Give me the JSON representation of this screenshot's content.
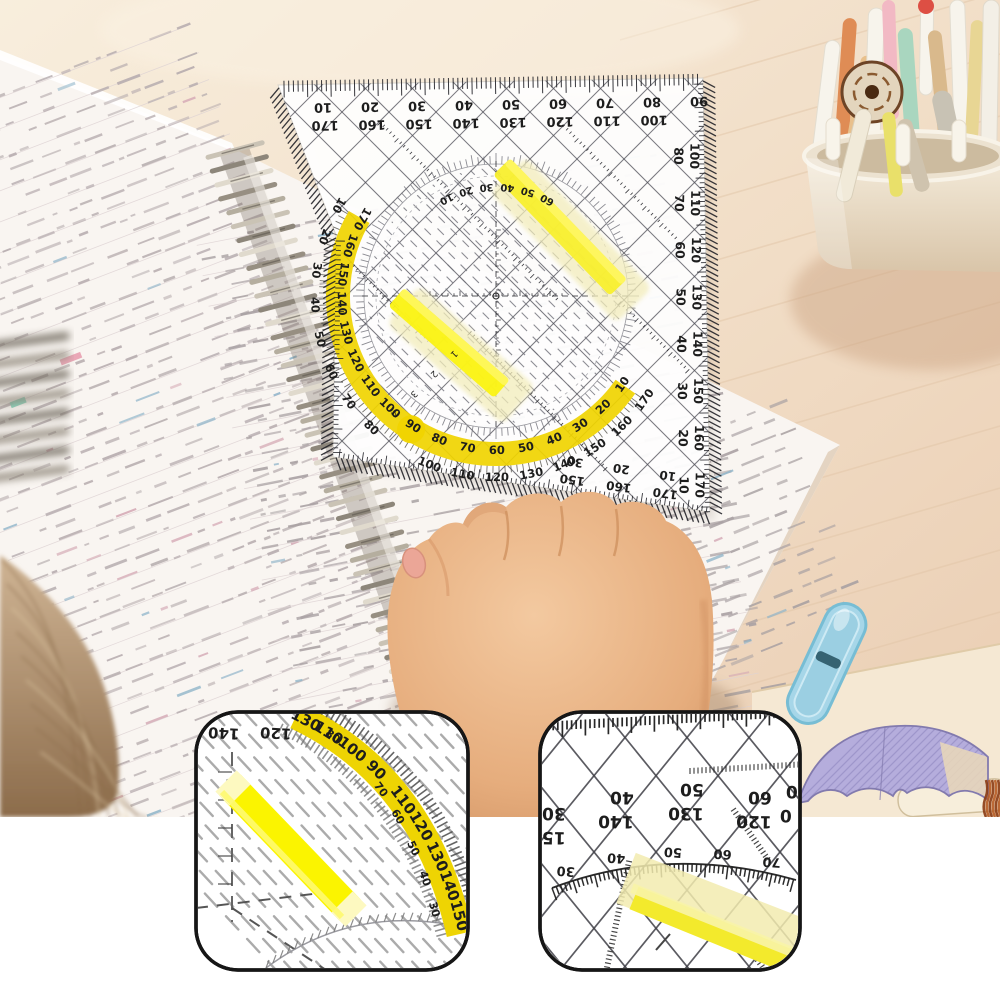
{
  "ruler": {
    "top_row_outer": [
      "10",
      "20",
      "30",
      "40",
      "50",
      "60",
      "70",
      "80",
      "90"
    ],
    "top_row_inner": [
      "170",
      "160",
      "150",
      "140",
      "130",
      "120",
      "110",
      "100"
    ],
    "right_pairs": [
      [
        "80",
        "100"
      ],
      [
        "70",
        "110"
      ],
      [
        "60",
        "120"
      ],
      [
        "50",
        "130"
      ],
      [
        "40",
        "140"
      ],
      [
        "30",
        "150"
      ],
      [
        "20",
        "160"
      ],
      [
        "10",
        "170"
      ]
    ],
    "bottom_pairs": [
      [
        "30",
        "150"
      ],
      [
        "20",
        "160"
      ],
      [
        "10",
        "170"
      ]
    ],
    "arc_outer": [
      "10",
      "20",
      "30",
      "40",
      "50",
      "60",
      "70",
      "80",
      "90",
      "100",
      "110",
      "120",
      "130",
      "140",
      "150",
      "160",
      "170"
    ],
    "arc_inner": [
      "170",
      "160",
      "150",
      "140",
      "130",
      "120",
      "110",
      "100",
      "90",
      "80",
      "70",
      "60",
      "50",
      "40",
      "30",
      "20",
      "10"
    ],
    "inner_top": [
      "10",
      "20",
      "30",
      "40",
      "50",
      "60"
    ],
    "diag_marks": [
      "1",
      "2",
      "3",
      "4"
    ]
  },
  "insets": {
    "left": {
      "corner_numbers": [
        "140",
        "120"
      ],
      "band_pairs": [
        [
          "130",
          ""
        ],
        [
          "110",
          ""
        ],
        [
          "100",
          "80"
        ],
        [
          "90",
          ""
        ],
        [
          "110",
          "70"
        ],
        [
          "120",
          "60"
        ],
        [
          "130",
          "50"
        ],
        [
          "140",
          "40"
        ],
        [
          "150",
          "30"
        ]
      ]
    },
    "right": {
      "pairs": [
        [
          "30",
          "150"
        ],
        [
          "40",
          "140"
        ],
        [
          "50",
          "130"
        ],
        [
          "60",
          "120"
        ],
        [
          "0",
          "0"
        ]
      ],
      "arc_numbers": [
        "30",
        "40",
        "50",
        "60",
        "70"
      ]
    }
  },
  "colors": {
    "desk_light": "#f7ecdb",
    "desk": "#f0dcc5",
    "desk_pink": "#ecd0b6",
    "page": "#f9f5f1",
    "writing": "#a8a0a2",
    "writing_left": "#b6acae",
    "ink": "#1d1d1d",
    "band_yellow": "#f0d400",
    "strip_yellow": "#f8ef2e",
    "strip_glow": "#f3edbb",
    "skin": "#eab88d",
    "skin_shadow": "#c98d5f",
    "arm_dark": "#a05a32",
    "hair": "#c2a482",
    "coil": "#9a9186",
    "blue_case": "#a6d6e8",
    "umbrella": "#b5addc",
    "cup": "#eee3d1",
    "inset_border": "#161616",
    "white": "#ffffff"
  }
}
